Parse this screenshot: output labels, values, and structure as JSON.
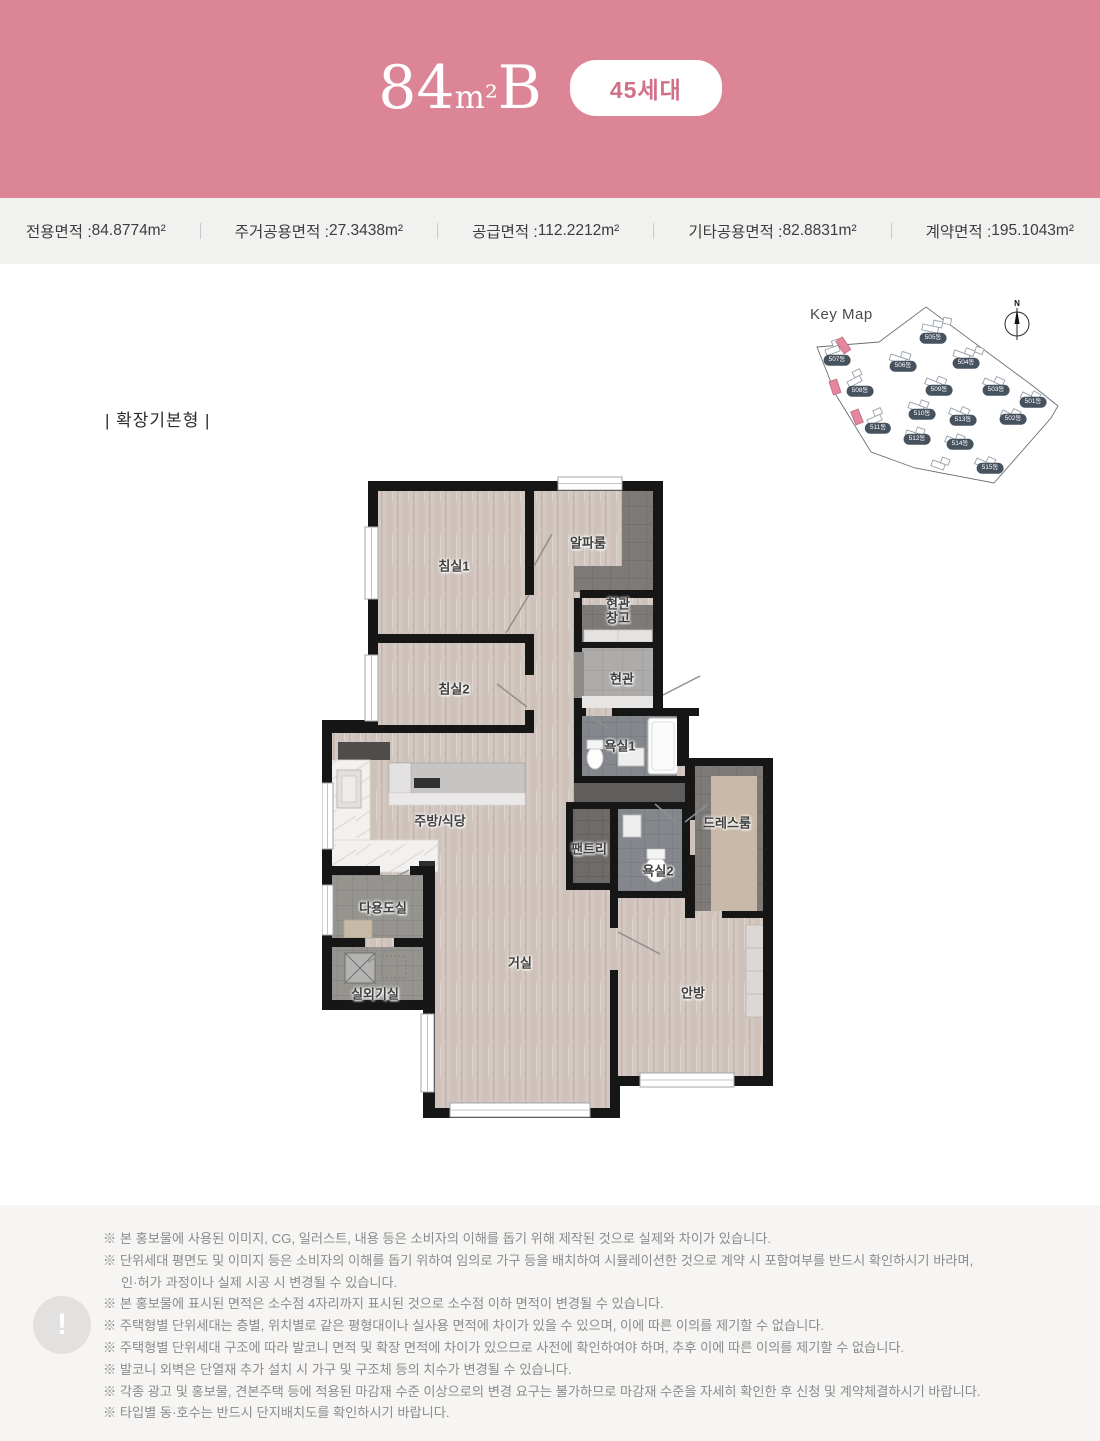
{
  "colors": {
    "header_pink": "#db8596",
    "badge_text_pink": "#d26f88",
    "strip_bg": "#f1f1f0",
    "footer_bg": "#f6f5f3",
    "wall_black": "#161616",
    "wood_floor": "#d4c9c2",
    "highlight_building_pink": "#e2879c",
    "badge_navy": "#47525f"
  },
  "header": {
    "title_num": "84",
    "title_unit": "m²",
    "title_letter": "B",
    "badge": "45세대"
  },
  "area_strip": {
    "items": [
      {
        "label": "전용면적",
        "value": "84.8774m²"
      },
      {
        "label": "주거공용면적",
        "value": "27.3438m²"
      },
      {
        "label": "공급면적",
        "value": "112.2212m²"
      },
      {
        "label": "기타공용면적",
        "value": "82.8831m²"
      },
      {
        "label": "계약면적",
        "value": "195.1043m²"
      }
    ]
  },
  "keymap": {
    "title": "Key Map",
    "north_label": "N",
    "buildings": [
      "501동",
      "502동",
      "503동",
      "504동",
      "505동",
      "506동",
      "507동",
      "508동",
      "509동",
      "510동",
      "511동",
      "512동",
      "513동",
      "514동",
      "515동"
    ]
  },
  "floorplan": {
    "variant_label": "| 확장기본형 |",
    "rooms": {
      "bedroom1": "침실1",
      "alpha_room": "알파룸",
      "entry_storage_line1": "현관",
      "entry_storage_line2": "창고",
      "entry": "현관",
      "bedroom2": "침실2",
      "bath1": "욕실1",
      "kitchen_dining": "주방/식당",
      "pantry": "팬트리",
      "dressroom": "드레스룸",
      "bath2": "욕실2",
      "utility": "다용도실",
      "living": "거실",
      "ac_room": "실외기실",
      "master": "안방"
    }
  },
  "footer": {
    "icon": "!",
    "lines": [
      "※ 본 홍보물에 사용된 이미지, CG, 일러스트, 내용 등은 소비자의 이해를 돕기 위해 제작된 것으로 실제와 차이가 있습니다.",
      "※ 단위세대 평면도 및 이미지 등은 소비자의 이해를 돕기 위하여 임의로 가구 등을 배치하여 시뮬레이션한 것으로 계약 시 포함여부를 반드시 확인하시기 바라며,",
      "인·허가 과정이나 실제 시공 시 변경될 수 있습니다.",
      "※ 본 홍보물에 표시된 면적은 소수점 4자리까지 표시된 것으로 소수점 이하 면적이 변경될 수 있습니다.",
      "※ 주택형별 단위세대는 층별, 위치별로 같은 평형대이나 실사용 면적에 차이가 있을 수 있으며, 이에 따른 이의를 제기할 수 없습니다.",
      "※ 주택형별 단위세대 구조에 따라 발코니 면적 및 확장 면적에 차이가 있으므로 사전에 확인하여야 하며, 추후 이에 따른 이의를 제기할 수 없습니다.",
      "※ 발코니 외벽은 단열재 추가 설치 시 가구 및 구조체 등의 치수가 변경될 수 있습니다.",
      "※ 각종 광고 및 홍보물, 견본주택 등에 적용된 마감재 수준 이상으로의 변경 요구는 불가하므로 마감재 수준을 자세히 확인한 후 신청 및 계약체결하시기 바랍니다.",
      "※ 타입별 동·호수는 반드시 단지배치도를 확인하시기 바랍니다."
    ]
  }
}
